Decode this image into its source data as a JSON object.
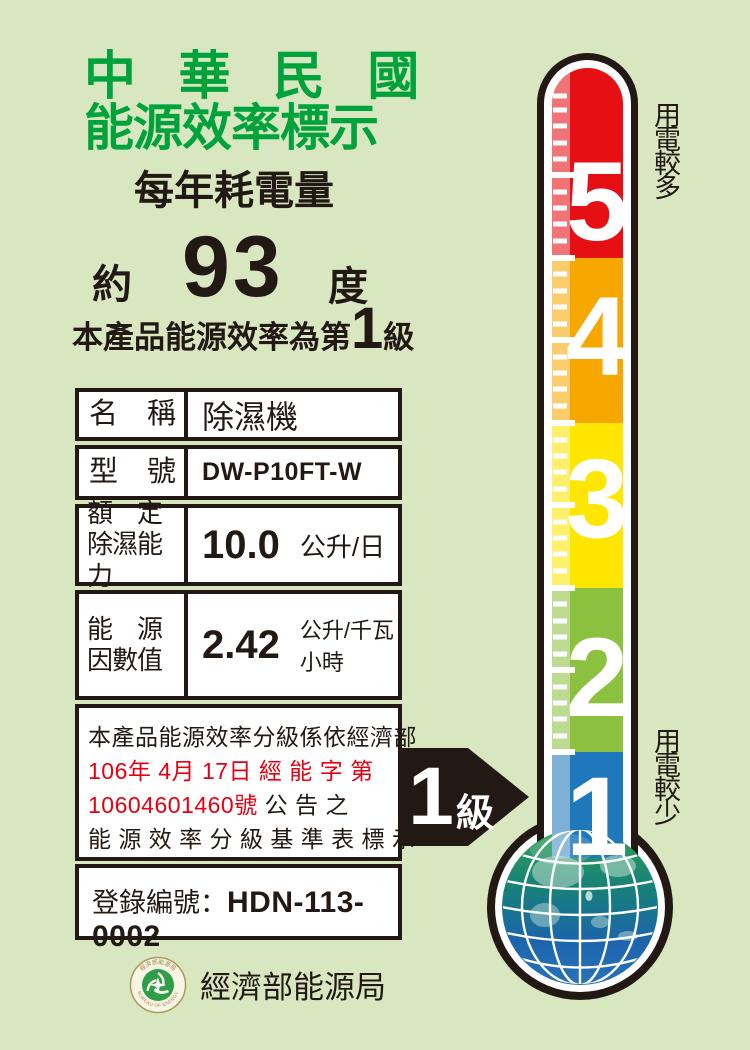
{
  "colors": {
    "background": "#d9e7c0",
    "title_green": "#00a23c",
    "text_black": "#221814",
    "notice_red": "#e60012",
    "arrow_black": "#221814",
    "globe_green": "#2fa254",
    "globe_blue": "#1c64ac"
  },
  "header": {
    "title_line1": "中 華 民 國",
    "title_line2": "能源效率標示",
    "annual_label": "每年耗電量",
    "approx_label": "約",
    "annual_value": "93",
    "degree_label": "度",
    "grade_prefix": "本產品能源效率為第",
    "grade_number": "1",
    "grade_suffix": "級"
  },
  "table": {
    "rows": [
      {
        "label": "名　稱",
        "value": "除濕機",
        "unit": ""
      },
      {
        "label": "型　號",
        "value": "DW-P10FT-W",
        "unit": ""
      },
      {
        "label": "額　定\n除濕能力",
        "value": "10.0",
        "unit": "公升/日"
      },
      {
        "label": "能　源\n因數值",
        "value": "2.42",
        "unit": "公升/千瓦小時"
      }
    ],
    "notice": {
      "line1": "本產品能源效率分級係依經濟部",
      "line2": "106年 4月 17日 經 能 字 第",
      "line3_red": "10604601460號",
      "line3_black": " 公 告 之",
      "line4": "能 源 效 率 分 級 基 準 表 標 示"
    },
    "registration_label": "登錄編號：",
    "registration_value": "HDN-113-0002"
  },
  "badge": {
    "value": "1",
    "suffix": "級"
  },
  "thermometer": {
    "more_label": "用電較多",
    "less_label": "用電較少",
    "levels": [
      {
        "label": "5",
        "color": "#e60f13"
      },
      {
        "label": "4",
        "color": "#f6a800"
      },
      {
        "label": "3",
        "color": "#ffe600"
      },
      {
        "label": "2",
        "color": "#8cc140"
      },
      {
        "label": "1",
        "color": "#1f78bb"
      }
    ]
  },
  "footer": {
    "agency": "經濟部能源局",
    "seal_top": "經濟部能源局",
    "seal_bottom": "BUREAU OF ENERGY"
  }
}
